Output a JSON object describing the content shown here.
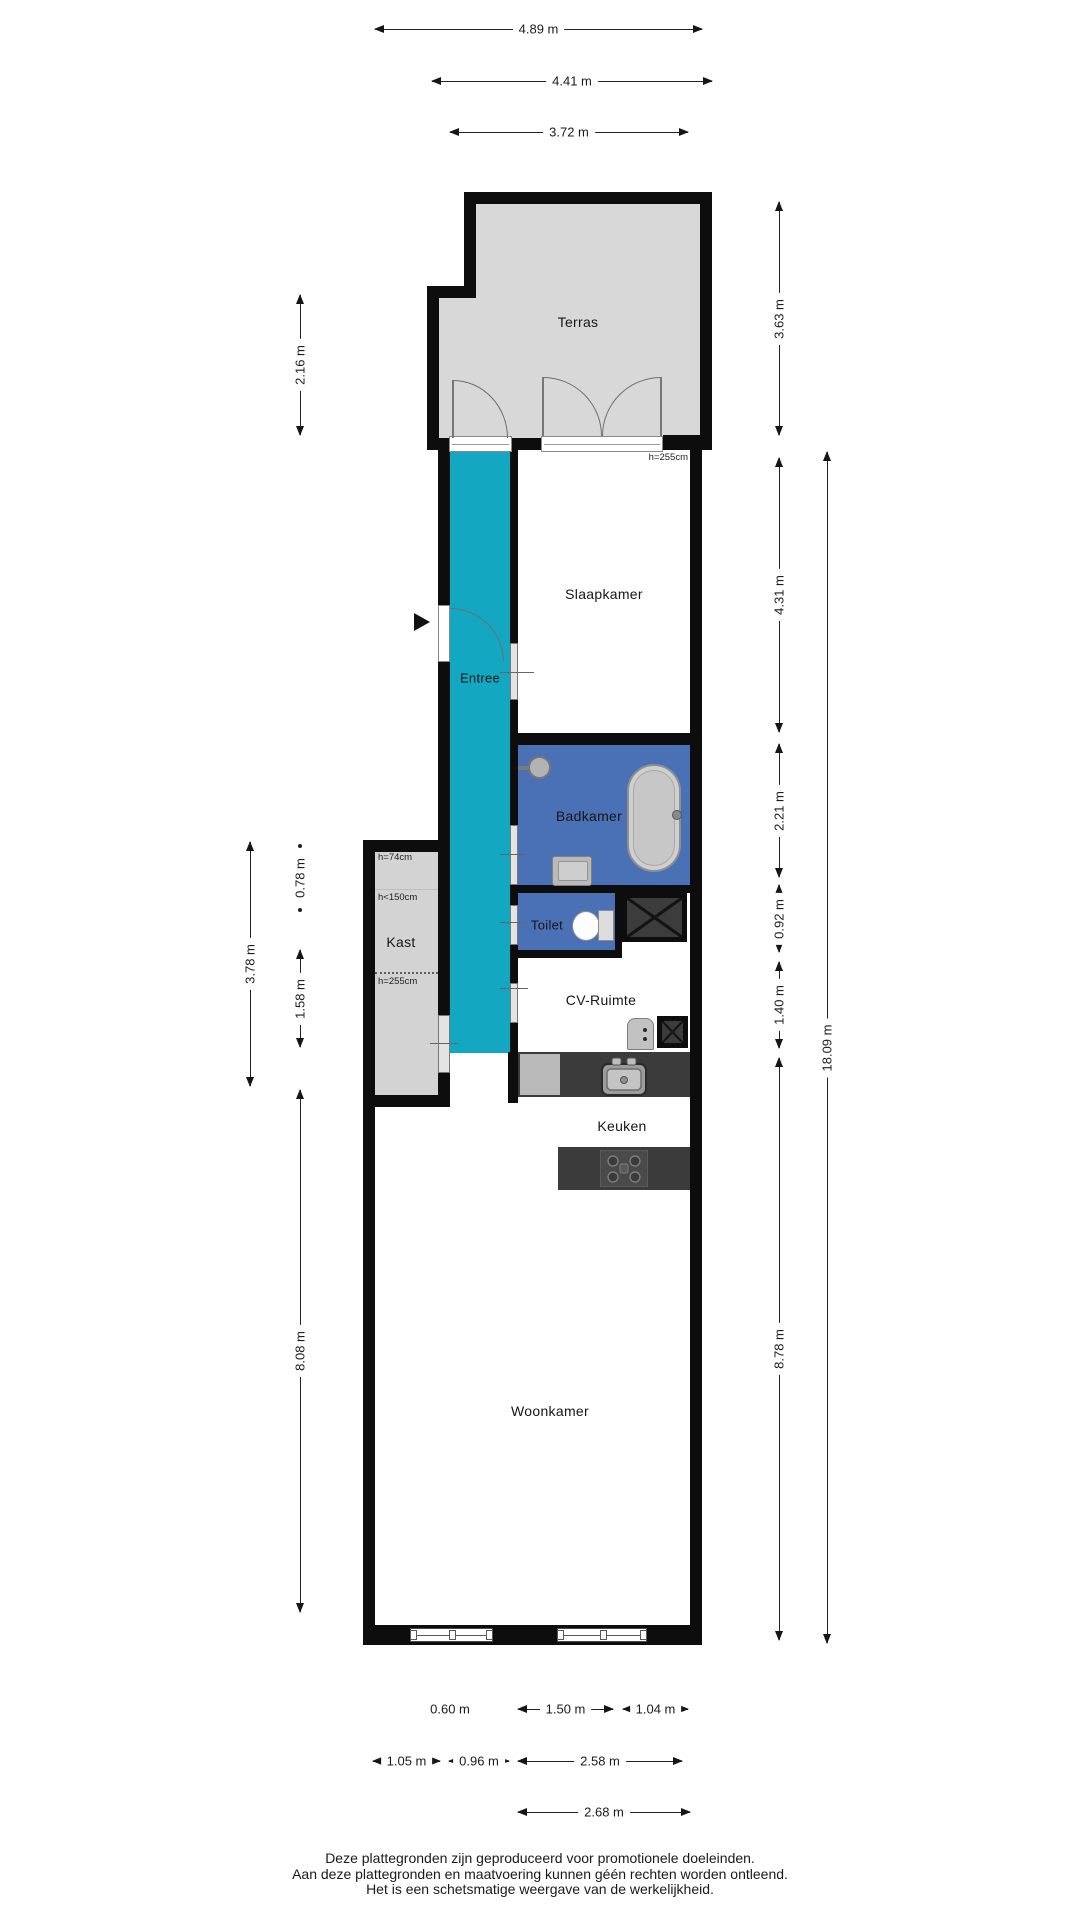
{
  "floorplan": {
    "rooms": {
      "terras": {
        "label": "Terras"
      },
      "slaapkamer": {
        "label": "Slaapkamer",
        "height_note": "h=255cm"
      },
      "entree": {
        "label": "Entree"
      },
      "badkamer": {
        "label": "Badkamer"
      },
      "kast": {
        "label": "Kast",
        "height_notes": [
          "h=74cm",
          "h<150cm",
          "h=255cm"
        ]
      },
      "toilet": {
        "label": "Toilet"
      },
      "cv_ruimte": {
        "label": "CV-Ruimte"
      },
      "keuken": {
        "label": "Keuken"
      },
      "woonkamer": {
        "label": "Woonkamer"
      }
    },
    "dims": {
      "top": [
        {
          "label": "4.89 m"
        },
        {
          "label": "4.41 m"
        },
        {
          "label": "3.72 m"
        }
      ],
      "right": [
        {
          "label": "3.63 m"
        },
        {
          "label": "4.31 m"
        },
        {
          "label": "2.21 m"
        },
        {
          "label": "0.92 m"
        },
        {
          "label": "1.40 m"
        },
        {
          "label": "8.78 m"
        },
        {
          "label": "18.09 m"
        }
      ],
      "left": [
        {
          "label": "2.16 m"
        },
        {
          "label": "0.78 m"
        },
        {
          "label": "3.78 m"
        },
        {
          "label": "1.58 m"
        },
        {
          "label": "8.08 m"
        }
      ],
      "bottom": [
        {
          "label": "0.60 m"
        },
        {
          "label": "1.50 m"
        },
        {
          "label": "1.04 m"
        },
        {
          "label": "1.05 m"
        },
        {
          "label": "0.96 m"
        },
        {
          "label": "2.58 m"
        },
        {
          "label": "2.68 m"
        }
      ]
    },
    "footer": {
      "lines": [
        "Deze plattegronden zijn geproduceerd voor promotionele doeleinden.",
        "Aan deze plattegronden en maatvoering kunnen géén rechten worden ontleend.",
        "Het is een schetsmatige weergave van de werkelijkheid."
      ]
    },
    "colors": {
      "wall": "#0d0d0d",
      "terrace_grey": "#d8d8d8",
      "closet_grey": "#d3d3d3",
      "corridor_teal": "#14a7c2",
      "wet_room_blue": "#4a71b5",
      "fixture_dark": "#3c3c3c"
    }
  }
}
